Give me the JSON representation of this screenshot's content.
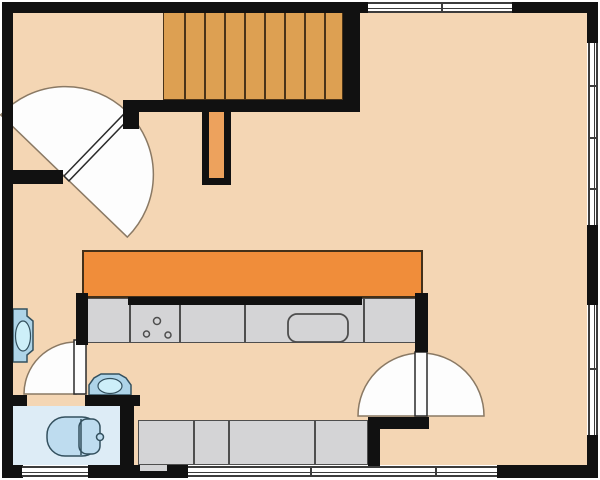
{
  "diagram": {
    "type": "architectural-floor-plan",
    "description": "Top-down floor plan of a level with a staircase, main room, kitchen counters and a bathroom",
    "rooms": [
      "main-room",
      "kitchen-area",
      "bathroom",
      "entry-hall",
      "stair-landing"
    ],
    "stairs": {
      "label": "staircase",
      "treads": 9,
      "position": "top-center"
    },
    "doors": [
      {
        "name": "entry-double-door",
        "style": "double-acting",
        "orientation": "diagonal",
        "location": "top-left"
      },
      {
        "name": "kitchen-double-door",
        "style": "double-acting",
        "orientation": "vertical-wall",
        "location": "bottom-right-of-kitchen"
      },
      {
        "name": "bathroom-door",
        "style": "single-swing",
        "swing": "opens-north",
        "location": "bathroom-entry"
      }
    ],
    "windows": [
      {
        "name": "top-wall-window",
        "wall": "top"
      },
      {
        "name": "right-wall-window-upper",
        "wall": "right"
      },
      {
        "name": "right-wall-window-lower",
        "wall": "right"
      },
      {
        "name": "bathroom-window",
        "wall": "bottom"
      },
      {
        "name": "bottom-wall-window-long",
        "wall": "bottom"
      }
    ],
    "fixtures": {
      "toilet": "toilet with tank, bathroom",
      "hall_sink": "wall-mounted sink on left wall",
      "corridor_sink": "small sink outside bathroom wall",
      "cooktop": "3-burner cooktop on main counter",
      "kitchen_sink": "rectangular basin on main counter",
      "bar_counter": "orange counter / bar top",
      "main_counter": "gray kitchen counter run",
      "lower_counter": "gray counter along bottom wall",
      "stair_rail_stub": "railing wall stub below stairs"
    }
  },
  "palette": {
    "bg": "#ffffff",
    "wall": "#111111",
    "floor": "#f4d6b4",
    "bathroom_floor": "#ddecf6",
    "stairs": "#dda052",
    "stair_line": "#4a3318",
    "rail_fill": "#eda25d",
    "counter_orange": "#f08d3a",
    "orange_line": "#433019",
    "counter_gray": "#d4d4d6",
    "counter_line": "#4e4e4e",
    "door_fill": "#fdfdfd",
    "arc_stroke": "#8a7964",
    "leaf_stroke": "#2b2b2b",
    "window_line": "#3c3c3c",
    "fixture_fill": "#bedcef",
    "fixture_fill_light": "#cdeff9",
    "fixture_outline": "#33505e",
    "sink_fill": "#aed4e8"
  }
}
